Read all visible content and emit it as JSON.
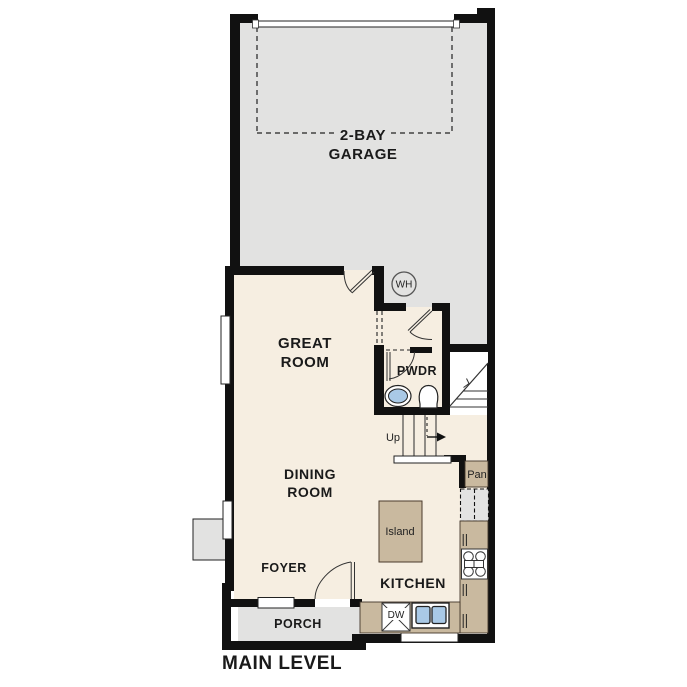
{
  "floorplan": {
    "level_title": "MAIN LEVEL",
    "garage": {
      "line1": "2-BAY",
      "line2": "GARAGE"
    },
    "great_room": {
      "line1": "GREAT",
      "line2": "ROOM"
    },
    "dining_room": {
      "line1": "DINING",
      "line2": "ROOM"
    },
    "kitchen": {
      "label": "KITCHEN",
      "island_label": "Island",
      "dishwasher_label": "DW",
      "pantry_label": "Pan"
    },
    "foyer": {
      "label": "FOYER"
    },
    "porch": {
      "label": "PORCH"
    },
    "powder_room": {
      "label": "PWDR"
    },
    "water_heater": {
      "label": "WH"
    },
    "stairs": {
      "direction_label": "Up"
    },
    "colors": {
      "walls": "#111111",
      "interior_floor": "#f6eee1",
      "garage_floor": "#e2e2e1",
      "counters": "#c9b99f",
      "fixture_blue": "#a9c9e6"
    }
  }
}
